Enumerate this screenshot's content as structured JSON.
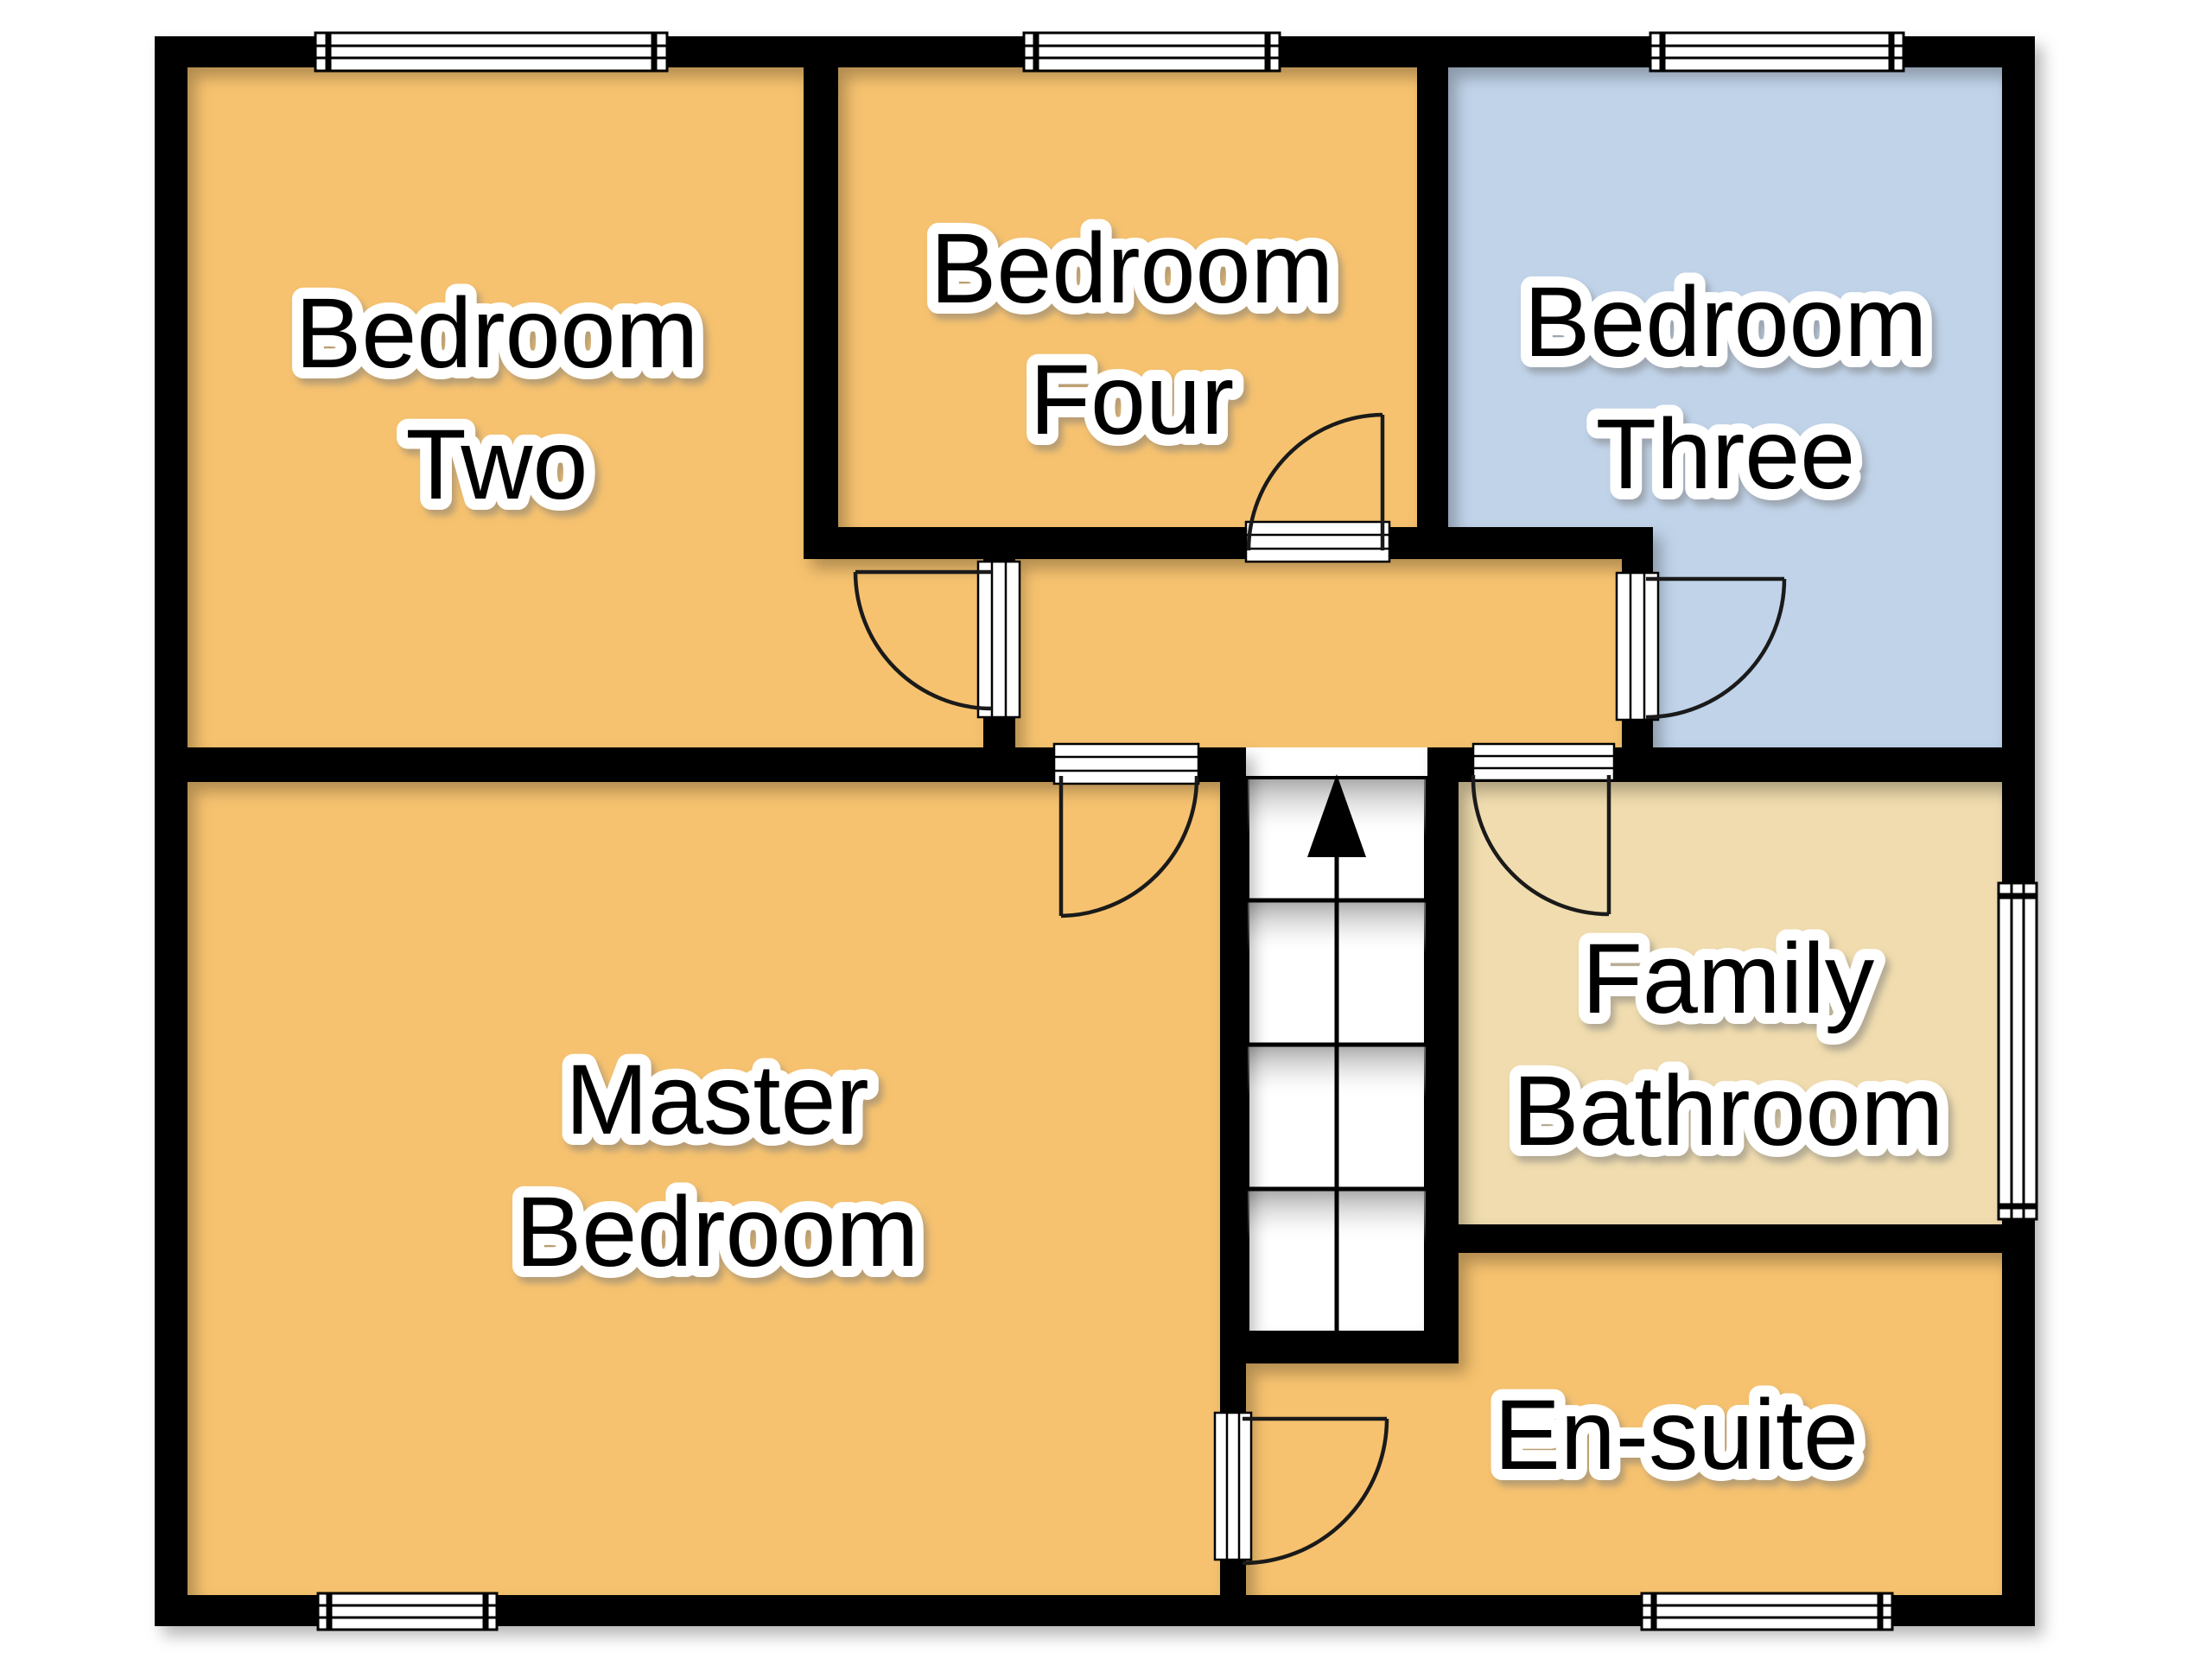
{
  "floorplan": {
    "type": "upper-floor residential floor plan",
    "colors": {
      "walls": "#000000",
      "background": "#ffffff",
      "door_lines": "#1a1a1a",
      "label_text": "#000000",
      "label_halo": "#ffffff",
      "bedroom_orange": "#F6C26F",
      "bedroom_blue": "#C0D3E9",
      "bathroom_cream": "#F0DCAE",
      "stairs_white": "#ffffff"
    },
    "rooms": {
      "bedroom_two": {
        "line1": "Bedroom",
        "line2": "Two",
        "color": "#F6C26F"
      },
      "bedroom_four": {
        "line1": "Bedroom",
        "line2": "Four",
        "color": "#F6C26F"
      },
      "bedroom_three": {
        "line1": "Bedroom",
        "line2": "Three",
        "color": "#C0D3E9"
      },
      "master_bedroom": {
        "line1": "Master",
        "line2": "Bedroom",
        "color": "#F6C26F"
      },
      "family_bathroom": {
        "line1": "Family",
        "line2": "Bathroom",
        "color": "#F0DCAE"
      },
      "en_suite": {
        "label": "En-suite",
        "color": "#F6C26F"
      },
      "landing": {
        "color": "#F6C26F"
      },
      "stairs": {
        "color": "#ffffff"
      }
    },
    "icons": {
      "stairs_up_arrow": "stairs-up-arrow-icon"
    },
    "counts": {
      "windows": 6,
      "doors": 6
    }
  }
}
